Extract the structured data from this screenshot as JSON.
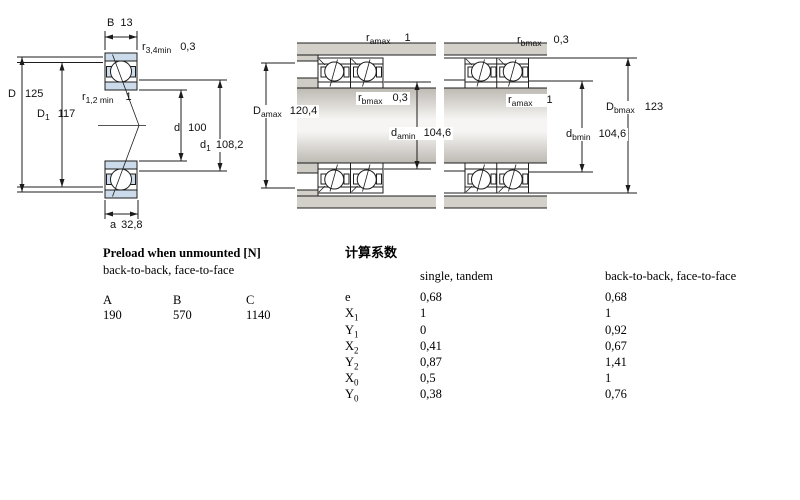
{
  "diagrams": {
    "left": {
      "dims": {
        "B": {
          "base": "B",
          "sub": "",
          "value": "13"
        },
        "r34": {
          "base": "r",
          "sub": "3,4min",
          "value": "0,3"
        },
        "D": {
          "base": "D",
          "sub": "",
          "value": "125"
        },
        "D1": {
          "base": "D",
          "sub": "1",
          "value": "117"
        },
        "r12": {
          "base": "r",
          "sub": "1,2 min",
          "value": "1"
        },
        "d": {
          "base": "d",
          "sub": "",
          "value": "100"
        },
        "d1": {
          "base": "d",
          "sub": "1",
          "value": "108,2"
        },
        "a": {
          "base": "a",
          "sub": "",
          "value": "32,8"
        }
      }
    },
    "middle": {
      "dims": {
        "ramax": {
          "base": "r",
          "sub": "amax",
          "value": "1"
        },
        "rbmax": {
          "base": "r",
          "sub": "bmax",
          "value": "0,3"
        },
        "Damax": {
          "base": "D",
          "sub": "amax",
          "value": "120,4"
        },
        "damin": {
          "base": "d",
          "sub": "amin",
          "value": "104,6"
        }
      }
    },
    "right": {
      "dims": {
        "rbmax": {
          "base": "r",
          "sub": "bmax",
          "value": "0,3"
        },
        "ramax": {
          "base": "r",
          "sub": "amax",
          "value": "1"
        },
        "Dbmax": {
          "base": "D",
          "sub": "bmax",
          "value": "123"
        },
        "dbmin": {
          "base": "d",
          "sub": "bmin",
          "value": "104,6"
        }
      }
    }
  },
  "preload": {
    "title": "Preload when unmounted [N]",
    "subtitle": "back-to-back, face-to-face",
    "columns": [
      "A",
      "B",
      "C"
    ],
    "values": [
      "190",
      "570",
      "1140"
    ]
  },
  "factors": {
    "title": "计算系数",
    "col_single": "single, tandem",
    "col_btb": "back-to-back, face-to-face",
    "rows": [
      {
        "label": {
          "base": "e",
          "sub": ""
        },
        "single": "0,68",
        "btb": "0,68"
      },
      {
        "label": {
          "base": "X",
          "sub": "1"
        },
        "single": "1",
        "btb": "1"
      },
      {
        "label": {
          "base": "Y",
          "sub": "1"
        },
        "single": "0",
        "btb": "0,92"
      },
      {
        "label": {
          "base": "X",
          "sub": "2"
        },
        "single": "0,41",
        "btb": "0,67"
      },
      {
        "label": {
          "base": "Y",
          "sub": "2"
        },
        "single": "0,87",
        "btb": "1,41"
      },
      {
        "label": {
          "base": "X",
          "sub": "0"
        },
        "single": "0,5",
        "btb": "1"
      },
      {
        "label": {
          "base": "Y",
          "sub": "0"
        },
        "single": "0,38",
        "btb": "0,76"
      }
    ]
  },
  "colors": {
    "ring_fill": "#cbdbeb",
    "metal": "#d3cfc9",
    "line": "#1c1c1c"
  }
}
